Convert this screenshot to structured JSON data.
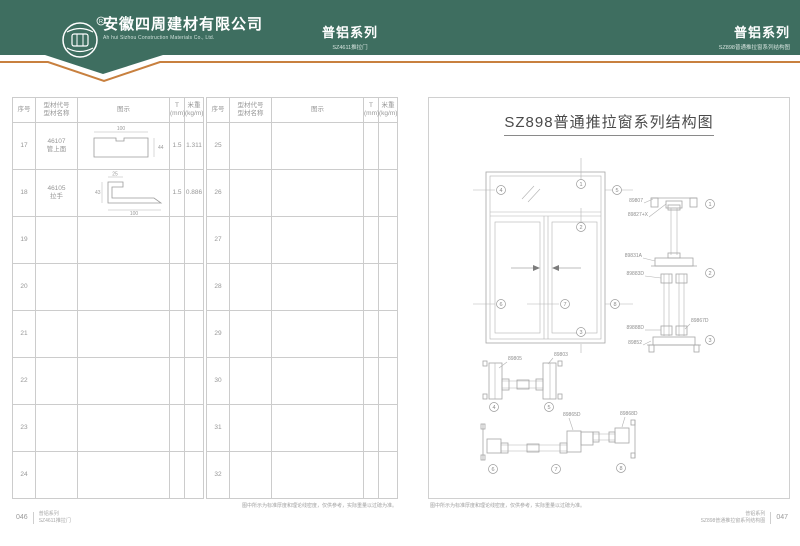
{
  "header": {
    "company_cn": "安徽四周建材有限公司",
    "company_en": "Ah hui Sizhou Construction Materials Co., Ltd.",
    "center_series": "普铝系列",
    "center_sub": "SZ4611推拉门",
    "right_series": "普铝系列",
    "right_sub": "SZ898普通推拉窗系列结构图",
    "registered_mark": "R",
    "colors": {
      "header_bg": "#3e6e60",
      "accent_orange": "#c8803f"
    }
  },
  "table": {
    "headers": {
      "no": "序号",
      "code": "型材代号",
      "name": "型材名称",
      "fig": "图示",
      "t1": "T",
      "t2": "(mm)",
      "w1": "米重",
      "w2": "(kg/m)"
    },
    "note": "图中所示为标准厚度和理论线密度，仅供参考，实际重量以过磅为准。",
    "halves": [
      {
        "rows": [
          {
            "no": "17",
            "code": "46107",
            "name": "管上面",
            "t": "1.5",
            "w": "1.311",
            "fig": "tube",
            "dims": {
              "top": "100",
              "right": "44"
            }
          },
          {
            "no": "18",
            "code": "46105",
            "name": "拉手",
            "t": "1.5",
            "w": "0.886",
            "fig": "handle",
            "dims": {
              "top": "25",
              "left": "43",
              "bottom": "100"
            }
          },
          {
            "no": "19"
          },
          {
            "no": "20"
          },
          {
            "no": "21"
          },
          {
            "no": "22"
          },
          {
            "no": "23"
          },
          {
            "no": "24"
          }
        ]
      },
      {
        "rows": [
          {
            "no": "25"
          },
          {
            "no": "26"
          },
          {
            "no": "27"
          },
          {
            "no": "28"
          },
          {
            "no": "29"
          },
          {
            "no": "30"
          },
          {
            "no": "31"
          },
          {
            "no": "32"
          }
        ]
      }
    ]
  },
  "diagram": {
    "title": "SZ898普通推拉窗系列结构图",
    "note": "图中所示为标准厚度和理论线密度，仅供参考，实际重量以过磅为准。",
    "callouts": {
      "c1": "1",
      "c2": "2",
      "c3": "3",
      "c4": "4",
      "c5": "5",
      "c6": "6",
      "c7": "7",
      "c8": "8"
    },
    "vertical_labels": {
      "top_frame": "89807",
      "glass_bead": "89827+X",
      "transom": "89831A",
      "interlock": "89883D",
      "roller": "89888D",
      "sill": "89852",
      "side_part": "89867D"
    },
    "section_a_labels": {
      "left": "89805",
      "right": "89803"
    },
    "section_b_labels": {
      "left": "89865D",
      "right": "89868D"
    }
  },
  "footer": {
    "left_page": "046",
    "left_series": "普铝系列",
    "left_sub": "SZ4611推拉门",
    "right_series": "普铝系列",
    "right_sub": "SZ898普通推拉窗系列结构图",
    "right_page": "047"
  }
}
